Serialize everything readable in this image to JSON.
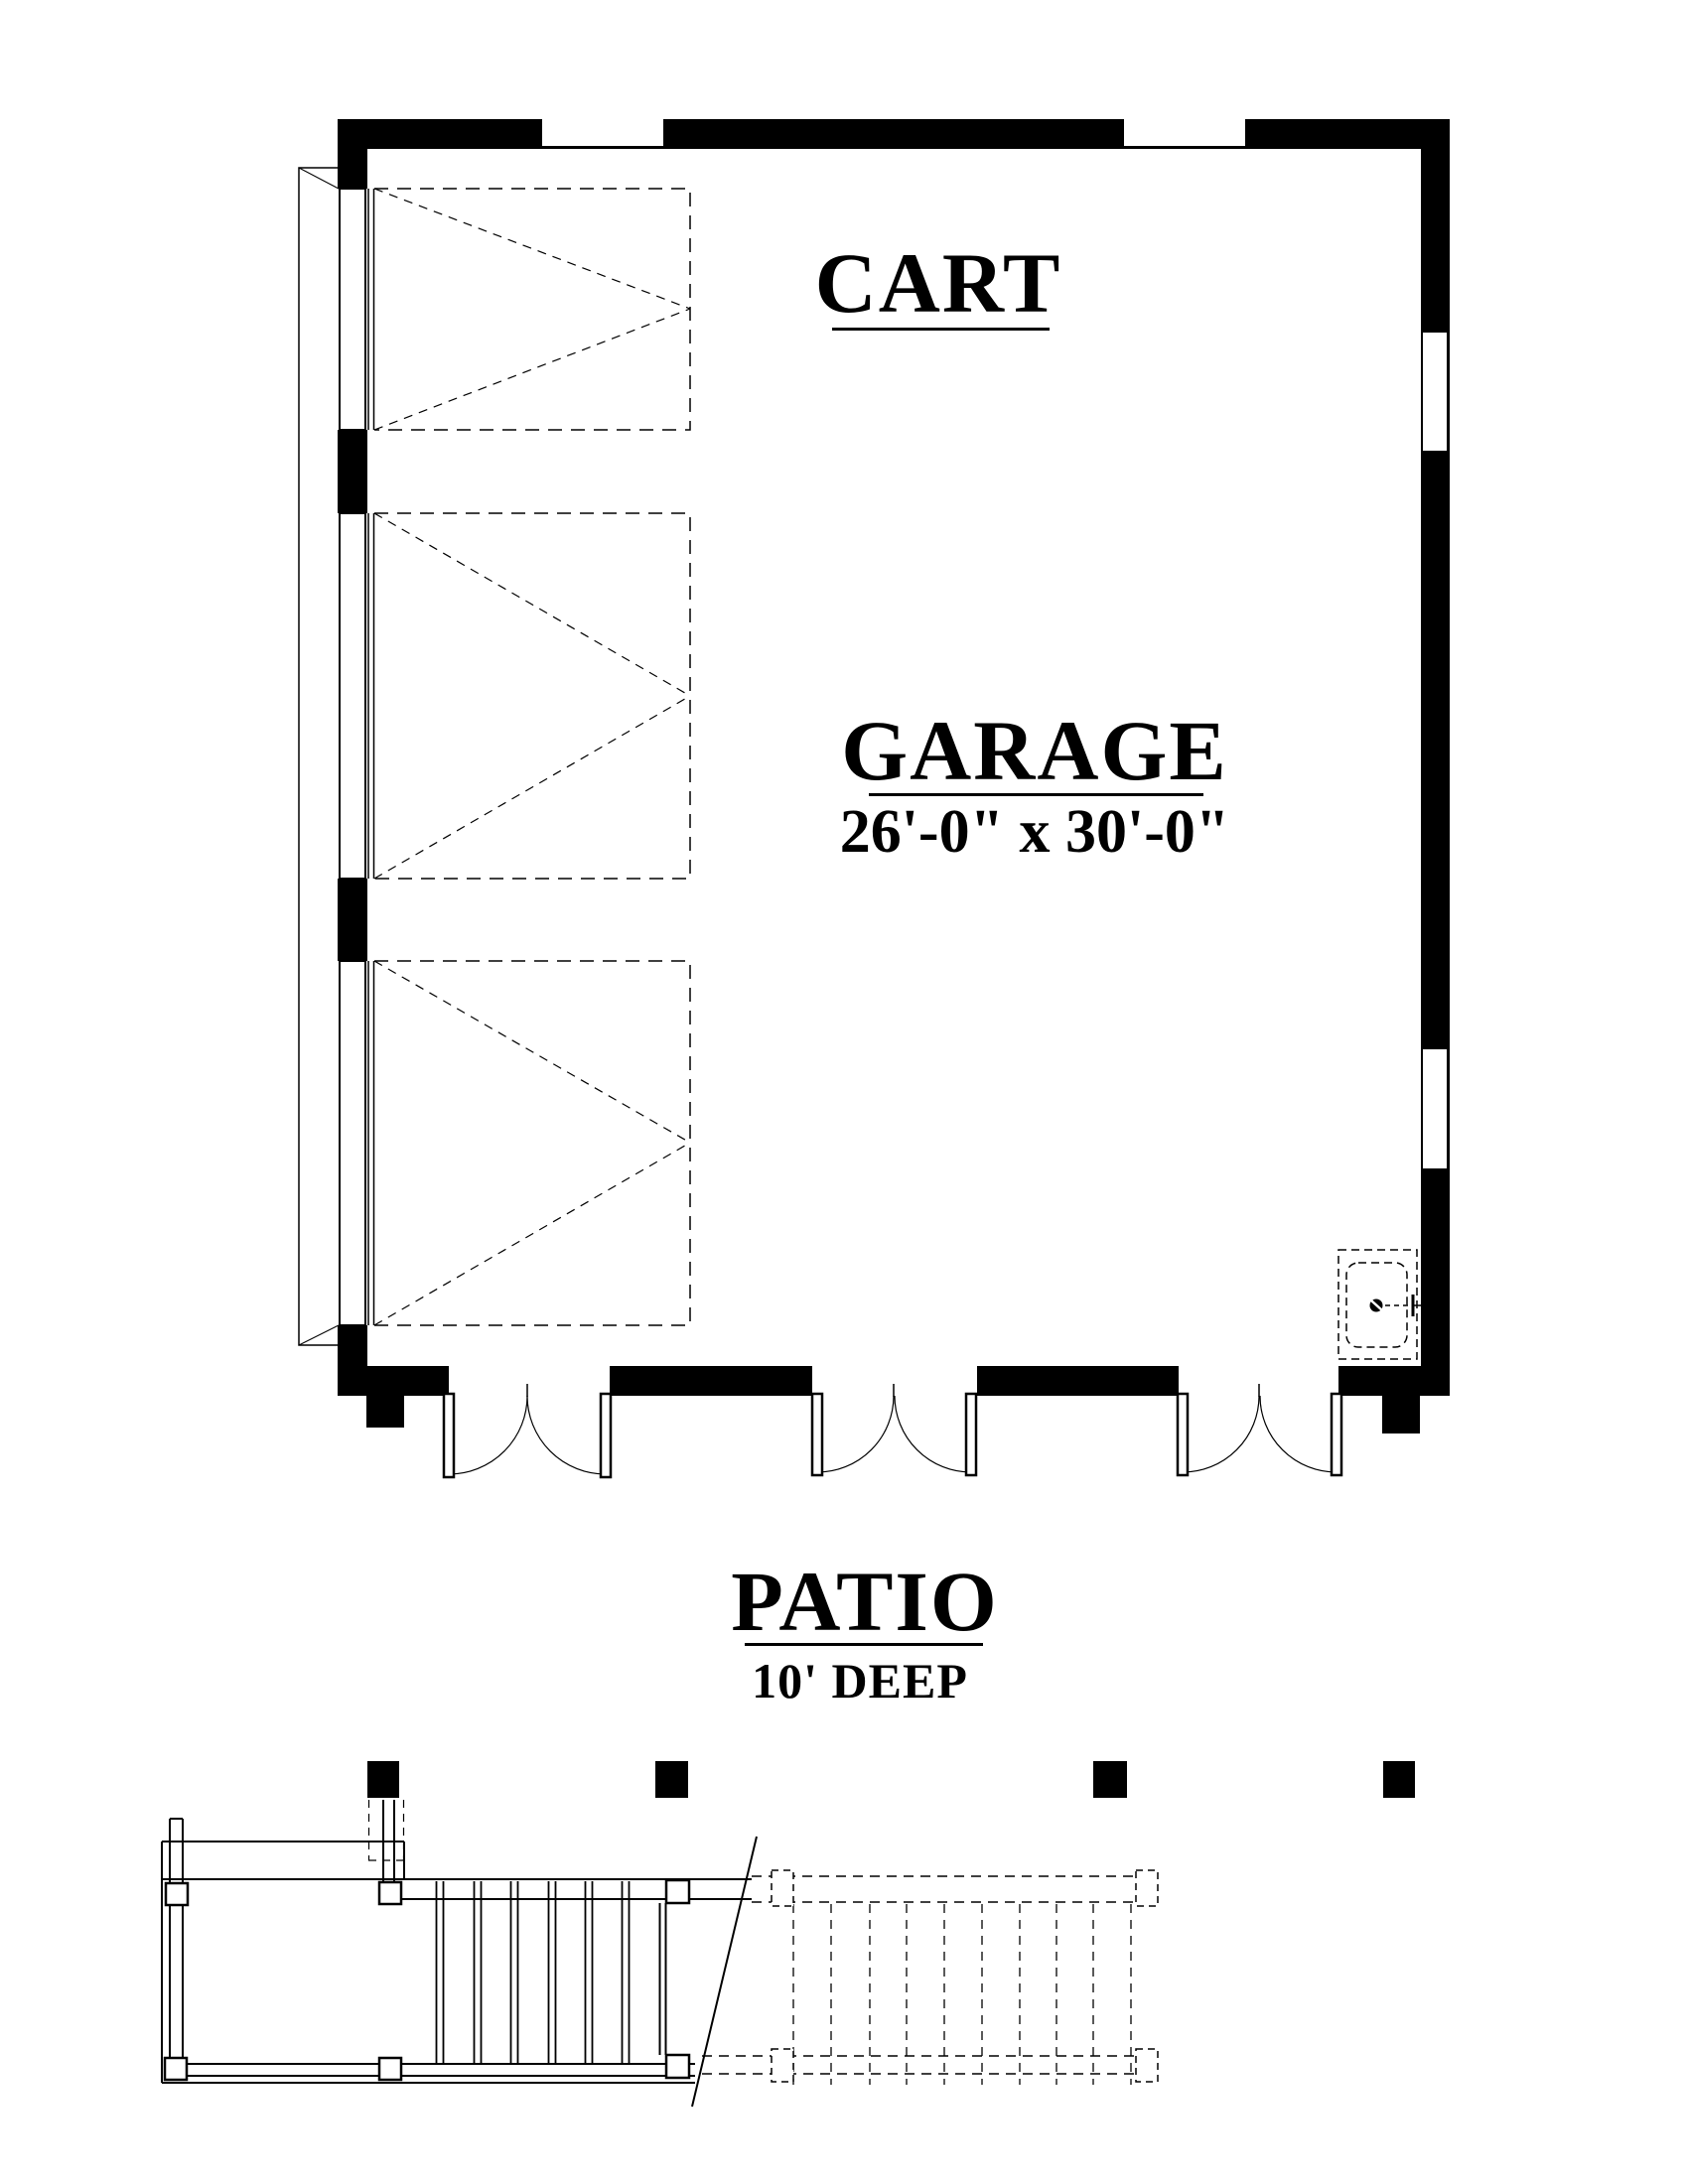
{
  "drawing": {
    "type": "floor-plan",
    "paper_color": "#ffffff",
    "ink_color": "#000000"
  },
  "rooms": [
    {
      "id": "cart",
      "label": "CART"
    },
    {
      "id": "garage",
      "label": "GARAGE",
      "size": "26'-0\" x 30'-0\""
    },
    {
      "id": "patio",
      "label": "PATIO",
      "size": "10' DEEP"
    }
  ],
  "features": {
    "garage_door_bays": 3,
    "patio_double_doors": 3,
    "top_wall_windows": 2,
    "right_wall_windows": 2,
    "patio_columns": 4,
    "fixtures": [
      "utility-sink",
      "stair-landing",
      "stairs"
    ]
  }
}
